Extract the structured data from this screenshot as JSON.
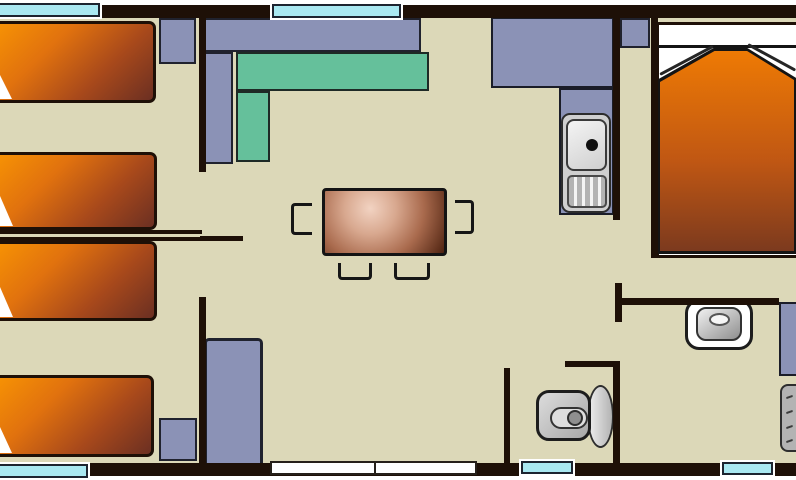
{
  "title": "Mobile home floor plan",
  "palette": {
    "background": "#ffffff",
    "floor": "#dcd8b8",
    "wall": "#1e1007",
    "window": "#a9e8f1",
    "windowFrame": "#ffffff",
    "door": "#ffffff",
    "cabinet": "#8b92b6",
    "sofa": "#65c09b",
    "bedLight": "#f69104",
    "bedMid1": "#e1720e",
    "bedMid2": "#a8491b",
    "bedDark": "#6b2f22",
    "duvetTop": "#ee7a04",
    "duvetMid": "#c05713",
    "duvetBottom": "#7c3a1e",
    "tableHi": "#f2d3c2",
    "tableLight": "#d8a88f",
    "tableMid": "#a96a4d",
    "tableDark": "#4e2210",
    "fixtureMid": "#cfcfcf",
    "fixtureGray": "#b3b3b3",
    "fixtureDark": "#8f8f8f"
  },
  "inventory": {
    "single_beds": 4,
    "double_beds": 1,
    "top_windows": 2,
    "bottom_windows": 3,
    "entrance_door_panels": 2,
    "items": [
      "single-bed",
      "single-bed",
      "single-bed",
      "single-bed",
      "double-bed",
      "corner-sofa",
      "dining-table",
      "chair",
      "chair",
      "chair",
      "chair",
      "kitchen-counter",
      "kitchen-sink",
      "tall-cupboard",
      "cupboard",
      "cupboard",
      "wardrobe",
      "washbasin",
      "toilet",
      "shower-cabinet",
      "water-heater"
    ]
  }
}
